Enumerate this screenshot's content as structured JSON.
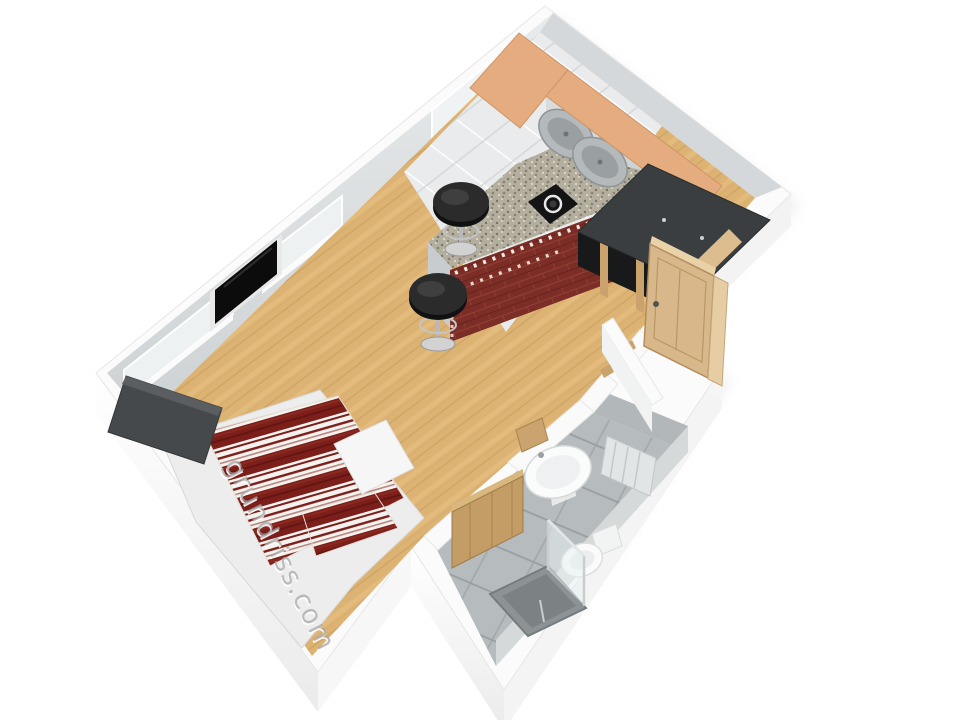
{
  "watermark": {
    "text": "grundriss.com"
  },
  "scene": {
    "title": "3D floor plan of a studio apartment, isometric bird view",
    "rooms": [
      "kitchen",
      "living-sleeping-area",
      "hallway",
      "bathroom"
    ],
    "furniture": [
      "tall-corner-cabinet",
      "kitchen-counter-with-double-sink",
      "cooktop",
      "granite-breakfast-bar",
      "brick-bar-front",
      "bar-stool-1",
      "bar-stool-2",
      "wardrobe",
      "entrance-door",
      "flat-tv",
      "windows",
      "double-bed",
      "headboard",
      "striped-duvet",
      "washbasin",
      "toilet",
      "shower",
      "shower-glass",
      "bathroom-wood-door",
      "radiator"
    ]
  },
  "colors": {
    "background": "#ffffff",
    "wall_top": "#fbfbfb",
    "wall_inner_face": "#dde1e3",
    "wood_floor": "#ddb374",
    "kitchen_tile": "#e9ebec",
    "bath_floor": "#b6bbbd",
    "granite": "#b3ae9d",
    "brick": "#7c2d26",
    "cabinet_top": "#e5ad7f",
    "cabinet_face": "#d3d6d8",
    "sink_steel": "#a9aeb0",
    "stove_black": "#141414",
    "wardrobe_dark": "#3a3e40",
    "door_wood": "#d8b88a",
    "duvet_red": "#7c1f1a",
    "duvet_white": "#f4f2ee",
    "headboard": "#46494b",
    "bed_linen": "#ededed",
    "fixture_white": "#fafbfb",
    "shower_tray": "#8d9395",
    "tv_black": "#0c0c0c",
    "watermark_gray": "#a8a8a8"
  }
}
